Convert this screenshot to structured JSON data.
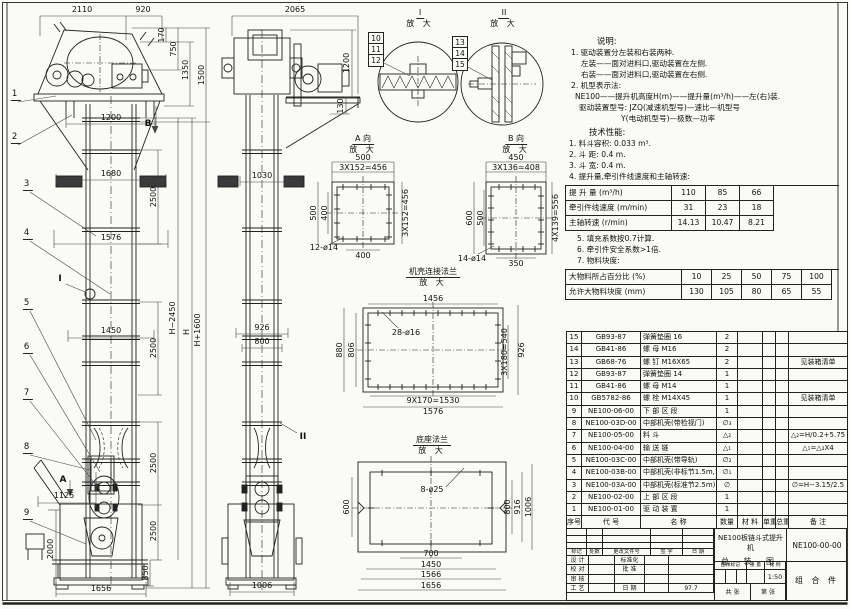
{
  "front_view": {
    "leaders": [
      "1",
      "2",
      "3",
      "4",
      "5",
      "6",
      "7",
      "8",
      "9"
    ],
    "marker_a": "A",
    "marker_b": "B",
    "marker_i": "I",
    "d2110": "2110",
    "d920": "920",
    "d170": "170",
    "d750": "750",
    "d1350": "1350",
    "d1500": "1500",
    "d1200": "1200",
    "d1680": "1680",
    "d1576": "1576",
    "d2500a": "2500",
    "d1450": "1450",
    "d2500b": "2500",
    "d2500c": "2500",
    "d2500d": "2500",
    "d850": "850",
    "d2000": "2000",
    "d1125": "1125",
    "d1656": "1656",
    "dh": "H",
    "dh_plus": "H+1600",
    "dh_minus": "H−2450"
  },
  "side_view": {
    "d2065": "2065",
    "d1200": "1200",
    "d130": "130",
    "d1030": "1030",
    "d926": "926",
    "d800": "800",
    "d1006": "1006",
    "marker_ii": "II"
  },
  "detail_i": {
    "title": "I",
    "sub": "放 大",
    "leaders": [
      "10",
      "11",
      "12"
    ]
  },
  "detail_ii": {
    "title": "II",
    "sub": "放 大",
    "leaders": [
      "13",
      "14",
      "15"
    ]
  },
  "view_a": {
    "title": "A 向",
    "sub": "放 大",
    "d_top": "500",
    "d_top2": "3X152=456",
    "d_left": "500",
    "d_left2": "400",
    "d_right": "3X152=456",
    "d_bottom": "400",
    "holes": "12-ø14"
  },
  "view_b": {
    "title": "B 向",
    "sub": "放 大",
    "d_top": "450",
    "d_top2": "3X136=408",
    "d_left": "600",
    "d_left2": "500",
    "d_right": "4X139=556",
    "d_bottom": "350",
    "holes": "14-ø14"
  },
  "flange_casing": {
    "title": "机壳连接法兰",
    "sub": "放 大",
    "d_top": "1456",
    "holes": "28-ø16",
    "d_left": "880",
    "d_left2": "806",
    "d_right": "926",
    "d_right2": "3X180=540",
    "d_bottom": "9X170=1530",
    "d_bottom2": "1576"
  },
  "flange_base": {
    "title": "底座法兰",
    "sub": "放 大",
    "holes": "8-ø25",
    "d_left": "600",
    "d_right_in": "800",
    "d_right_mid": "916",
    "d_right_out": "1006",
    "d_b1": "700",
    "d_b2": "1450",
    "d_b3": "1566",
    "d_b4": "1656"
  },
  "notes": {
    "heading": "说明:",
    "lines": [
      "1. 驱动装置分左装和右装两种.",
      "左装——面对进料口,驱动装置在左侧.",
      "右装——面对进料口,驱动装置在右侧.",
      "2. 机型表示法:",
      "NE100——提升机高度H(m)——提升量(m³/h)——左(右)装.",
      "驱动装置型号: JZQ(减速机型号)—速比—机型号",
      "Y(电动机型号)—极数—功率"
    ]
  },
  "performance": {
    "heading": "技术性能:",
    "lines_a": [
      "1. 料斗容积: 0.033 m³.",
      "2. 斗  距: 0.4 m.",
      "3. 斗  宽: 0.4 m.",
      "4. 提升量,牵引件线速度和主轴转速:"
    ],
    "table_speed": {
      "rows": [
        {
          "label": "提 升 量  (m³/h)",
          "v1": "110",
          "v2": "85",
          "v3": "66"
        },
        {
          "label": "牵引件线速度 (m/min)",
          "v1": "31",
          "v2": "23",
          "v3": "18"
        },
        {
          "label": "主轴转速 (r/min)",
          "v1": "14.13",
          "v2": "10.47",
          "v3": "8.21"
        }
      ]
    },
    "lines_b": [
      "5. 填充系数按0.7计算.",
      "6. 牵引件安全系数>1倍.",
      "7. 物料块度:"
    ],
    "table_lump": {
      "rows": [
        {
          "label": "大物料所占百分比 (%)",
          "v1": "10",
          "v2": "25",
          "v3": "50",
          "v4": "75",
          "v5": "100"
        },
        {
          "label": "允许大物料块度 (mm)",
          "v1": "130",
          "v2": "105",
          "v3": "80",
          "v4": "65",
          "v5": "55"
        }
      ]
    }
  },
  "bom": {
    "headers": [
      "序号",
      "代  号",
      "名  称",
      "数量",
      "材 料",
      "单重",
      "总重",
      "备  注"
    ],
    "rows": [
      {
        "no": "15",
        "code": "GB93-87",
        "name": "弹簧垫圈  16",
        "qty": "2",
        "material": "",
        "unit": "",
        "total": "",
        "remark": ""
      },
      {
        "no": "14",
        "code": "GB41-86",
        "name": "螺 母  M16",
        "qty": "2",
        "material": "",
        "unit": "",
        "total": "",
        "remark": ""
      },
      {
        "no": "13",
        "code": "GB68-76",
        "name": "螺 钉  M16X65",
        "qty": "2",
        "material": "",
        "unit": "",
        "total": "",
        "remark": "见装箱清单"
      },
      {
        "no": "12",
        "code": "GB93-87",
        "name": "弹簧垫圈  14",
        "qty": "1",
        "material": "",
        "unit": "",
        "total": "",
        "remark": ""
      },
      {
        "no": "11",
        "code": "GB41-86",
        "name": "螺 母  M14",
        "qty": "1",
        "material": "",
        "unit": "",
        "total": "",
        "remark": ""
      },
      {
        "no": "10",
        "code": "GB5782-86",
        "name": "螺 栓  M14X45",
        "qty": "1",
        "material": "",
        "unit": "",
        "total": "",
        "remark": "见装箱清单"
      },
      {
        "no": "9",
        "code": "NE100-06-00",
        "name": "下 部 区 段",
        "qty": "1",
        "material": "",
        "unit": "",
        "total": "",
        "remark": ""
      },
      {
        "no": "8",
        "code": "NE100-03D-00",
        "name": "中部机壳(带检视门)",
        "qty": "∅₃",
        "material": "",
        "unit": "",
        "total": "",
        "remark": ""
      },
      {
        "no": "7",
        "code": "NE100-05-00",
        "name": "料  斗",
        "qty": "△₂",
        "material": "",
        "unit": "",
        "total": "",
        "remark": "△₂=H/0.2+5.75"
      },
      {
        "no": "6",
        "code": "NE100-04-00",
        "name": "输 送 链",
        "qty": "△₁",
        "material": "",
        "unit": "",
        "total": "",
        "remark": "△₁=△₂X4"
      },
      {
        "no": "5",
        "code": "NE100-03C-00",
        "name": "中部机壳(带导轨)",
        "qty": "∅₂",
        "material": "",
        "unit": "",
        "total": "",
        "remark": ""
      },
      {
        "no": "4",
        "code": "NE100-03B-00",
        "name": "中部机壳(非标节1.5m,1m)",
        "qty": "∅₁",
        "material": "",
        "unit": "",
        "total": "",
        "remark": ""
      },
      {
        "no": "3",
        "code": "NE100-03A-00",
        "name": "中部机壳(标准节2.5m)",
        "qty": "∅",
        "material": "",
        "unit": "",
        "total": "",
        "remark": "∅=H−3.15/2.5"
      },
      {
        "no": "2",
        "code": "NE100-02-00",
        "name": "上 部 区 段",
        "qty": "1",
        "material": "",
        "unit": "",
        "total": "",
        "remark": ""
      },
      {
        "no": "1",
        "code": "NE100-01-00",
        "name": "驱 动 装 置",
        "qty": "1",
        "material": "",
        "unit": "",
        "total": "",
        "remark": ""
      }
    ]
  },
  "title_block": {
    "rev_headers": [
      "标记",
      "处数",
      "更改文件号",
      "签  字",
      "日  期"
    ],
    "roles": {
      "design": "设 计",
      "check": "校 对",
      "review": "审 核",
      "process": "工 艺",
      "standard": "标准化",
      "approve": "批 准",
      "date_label": "日 期",
      "date": "97.7"
    },
    "stamp": {
      "mark": "图样标记",
      "weight": "重 量",
      "scale_label": "比 例",
      "scale": "1:50"
    },
    "sheets": {
      "total": "共  张",
      "page": "第  张"
    },
    "title": "NE100板链斗式提升机",
    "subtitle": "总 装 图",
    "dwg_no": "NE100-00-00",
    "part_type": "组 合 件"
  }
}
